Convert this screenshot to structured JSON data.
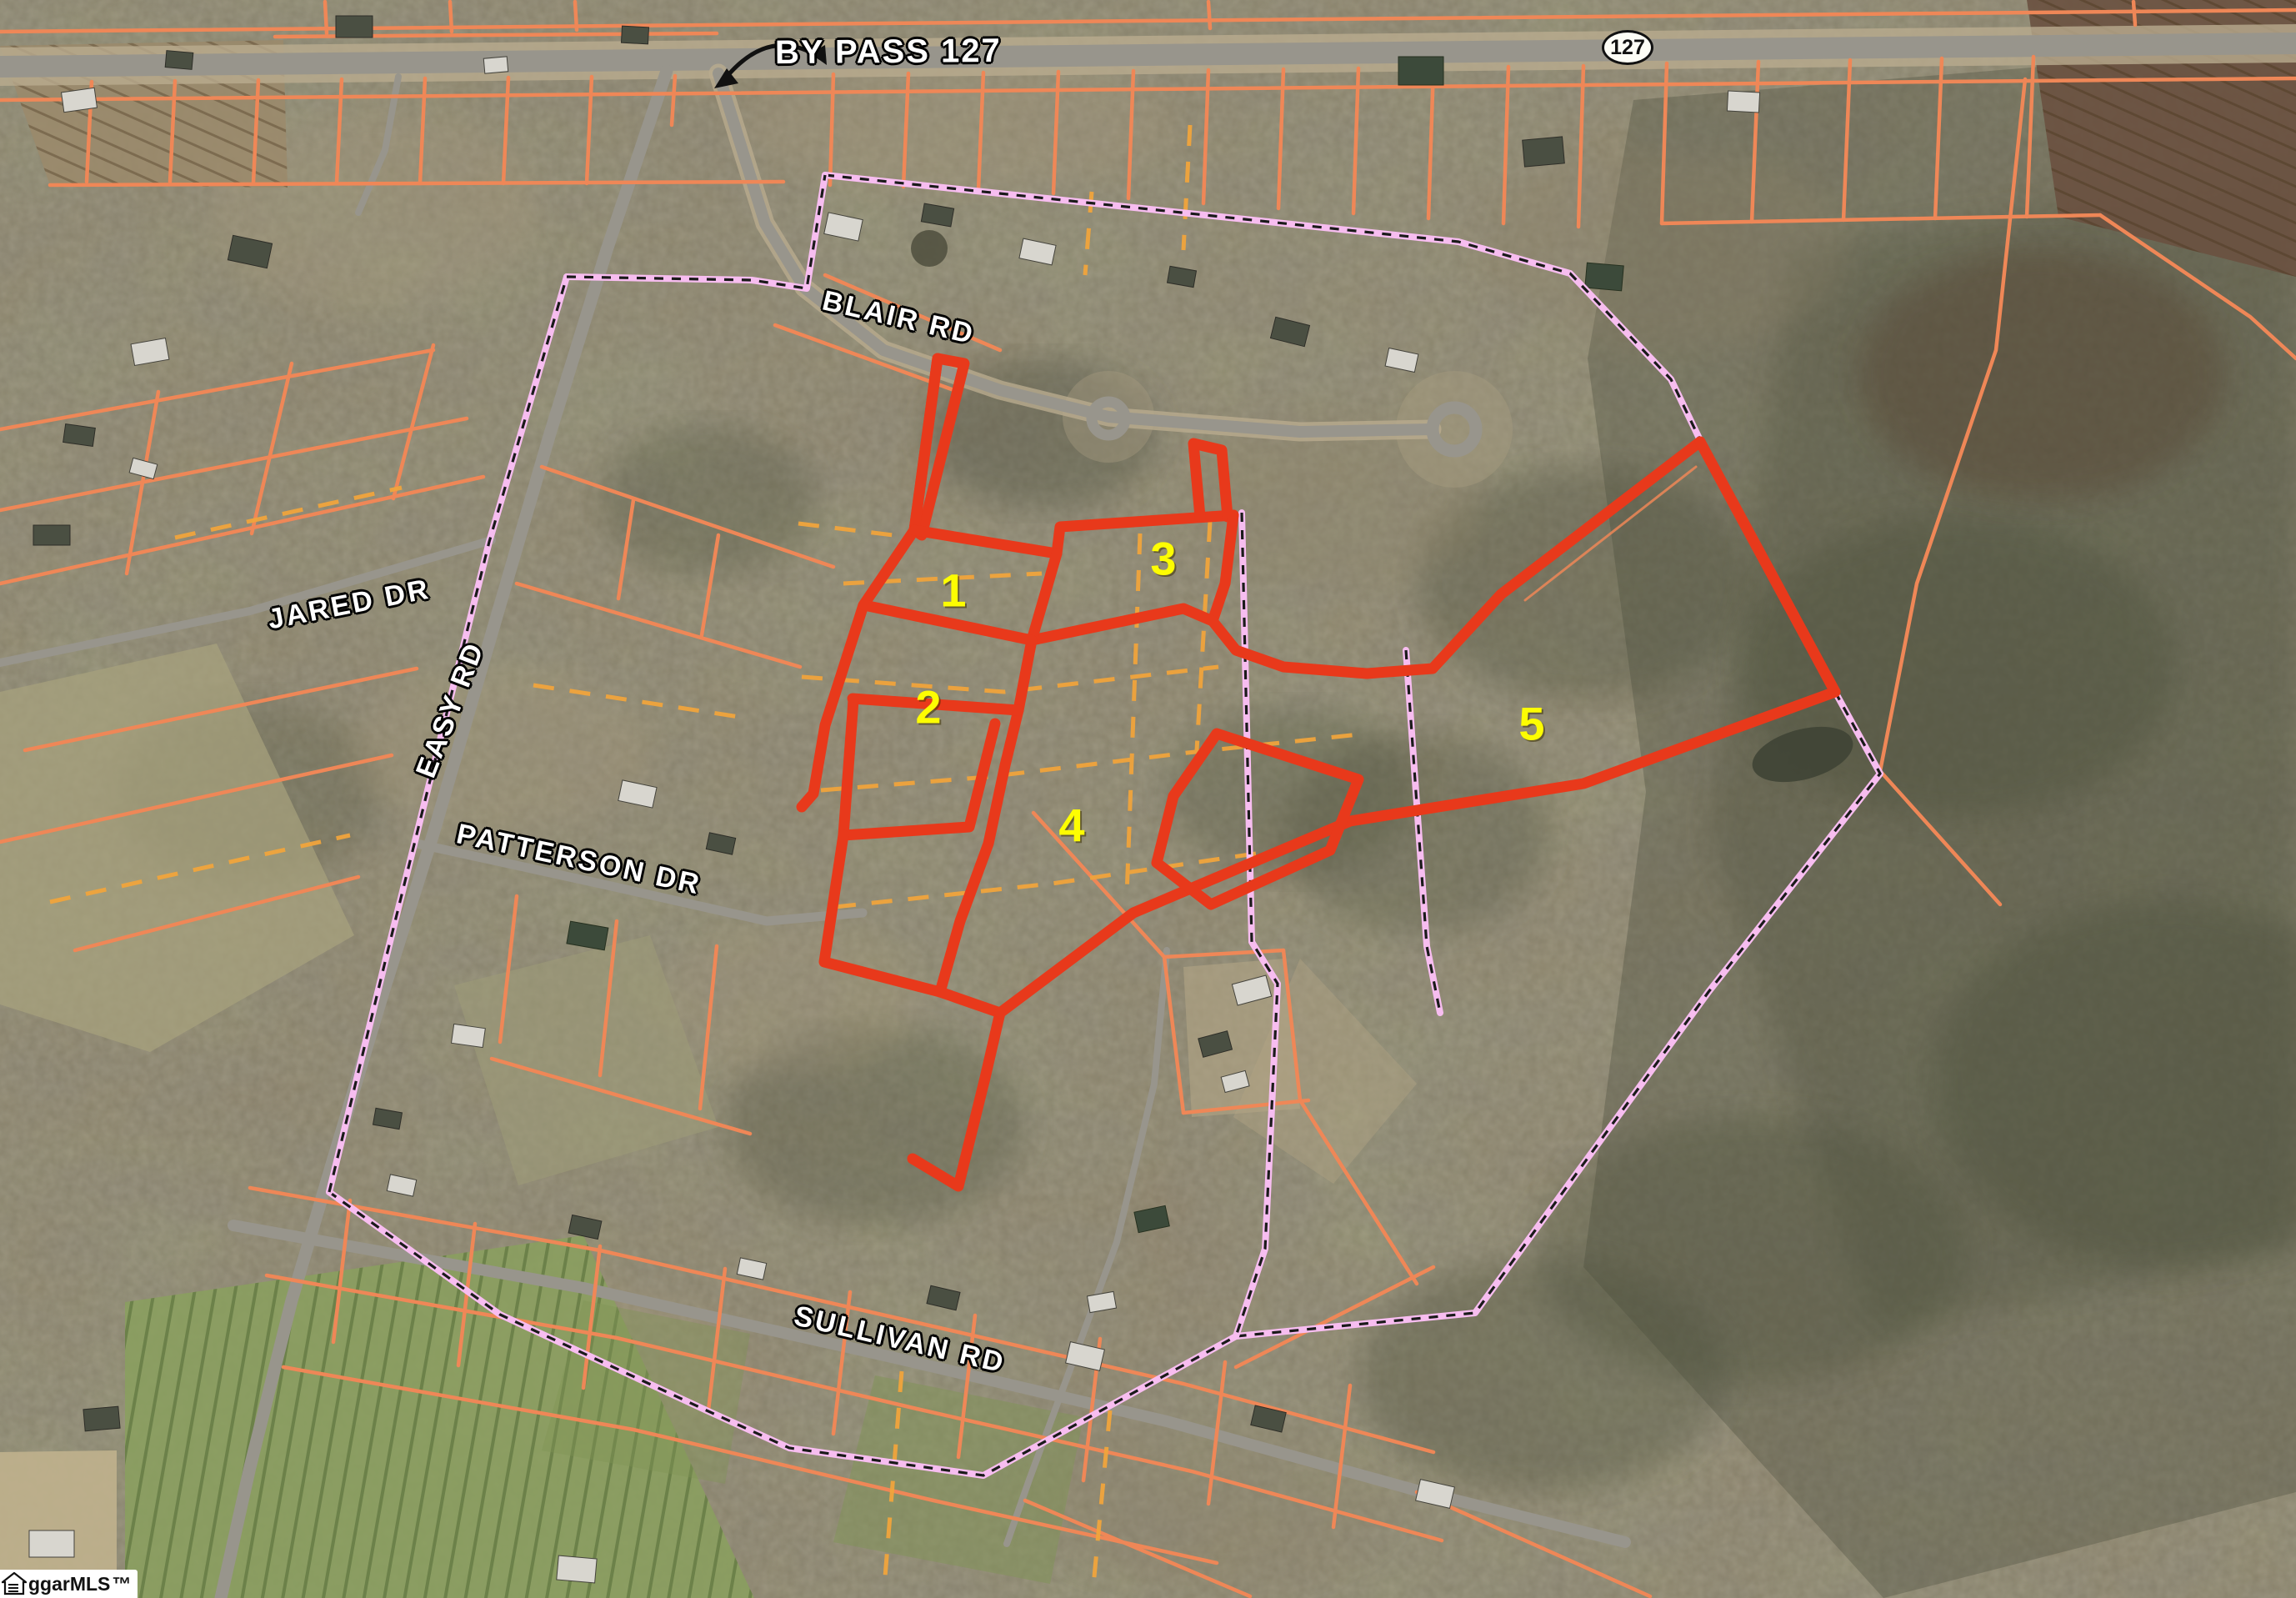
{
  "map": {
    "highway_label": "BY PASS 127",
    "route_shield": "127",
    "roads": {
      "blair": "BLAIR RD",
      "jared": "JARED DR",
      "easy": "EASY RD",
      "patterson": "PATTERSON DR",
      "sullivan": "SULLIVAN RD"
    },
    "parcels": [
      {
        "number": "1"
      },
      {
        "number": "2"
      },
      {
        "number": "3"
      },
      {
        "number": "4"
      },
      {
        "number": "5"
      }
    ],
    "watermark": {
      "text": "ggarMLS",
      "tm": "™"
    }
  },
  "colors": {
    "parcel-outline": "#e8391b",
    "boundary-pink": "#f7bdf0",
    "boundary-dash": "#1a1a1a",
    "lot-line-orange": "#ef8757",
    "interior-dash-yellow": "#f0a43c",
    "parcel-number": "#fdfd02",
    "road-label": "#ffffff",
    "road-fill": "#98958c",
    "shield-text": "#111111"
  }
}
